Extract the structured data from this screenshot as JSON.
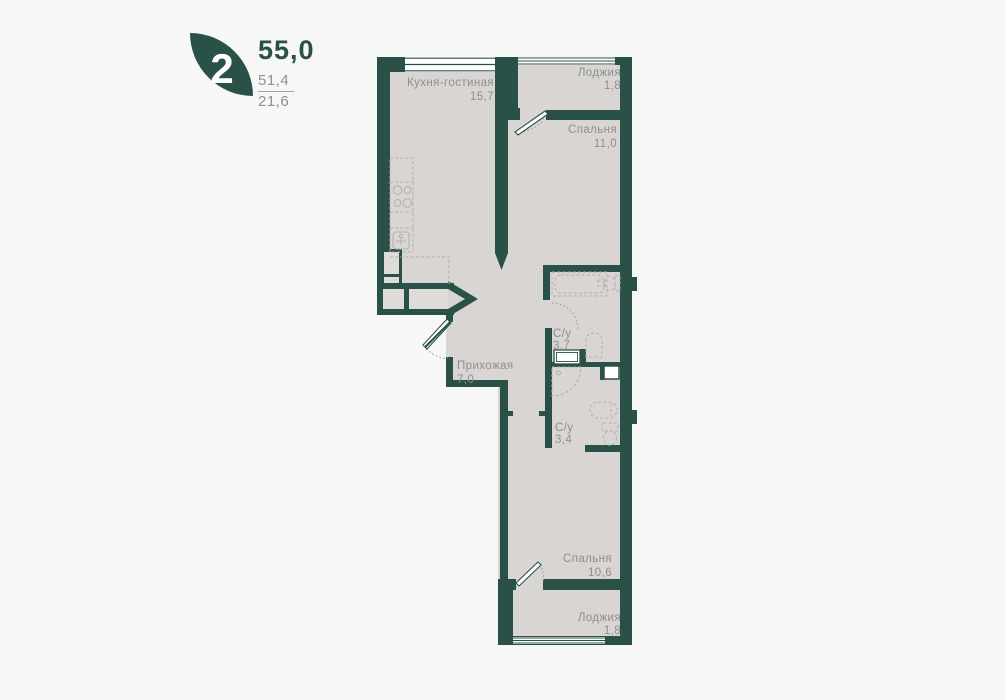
{
  "header": {
    "badge": "2",
    "total_area": "55,0",
    "secondary_area": "51,4",
    "tertiary_area": "21,6"
  },
  "rooms": [
    {
      "name": "Кухня-гостиная",
      "area": "15,7"
    },
    {
      "name": "Лоджия",
      "area": "1,8"
    },
    {
      "name": "Спальня",
      "area": "11,0"
    },
    {
      "name": "Прихожая",
      "area": "7,0"
    },
    {
      "name": "С/у",
      "area": "3,7"
    },
    {
      "name": "С/у",
      "area": "3,4"
    },
    {
      "name": "Спальня",
      "area": "10,6"
    },
    {
      "name": "Лоджия",
      "area": "1,8"
    }
  ],
  "colors": {
    "wall": "#2a5148",
    "floor": "#d8d5d2",
    "background": "#f7f7f6",
    "label_text": "#8f8f8c",
    "fixture_line": "#b2b0ac",
    "window_fill": "#ffffff"
  }
}
